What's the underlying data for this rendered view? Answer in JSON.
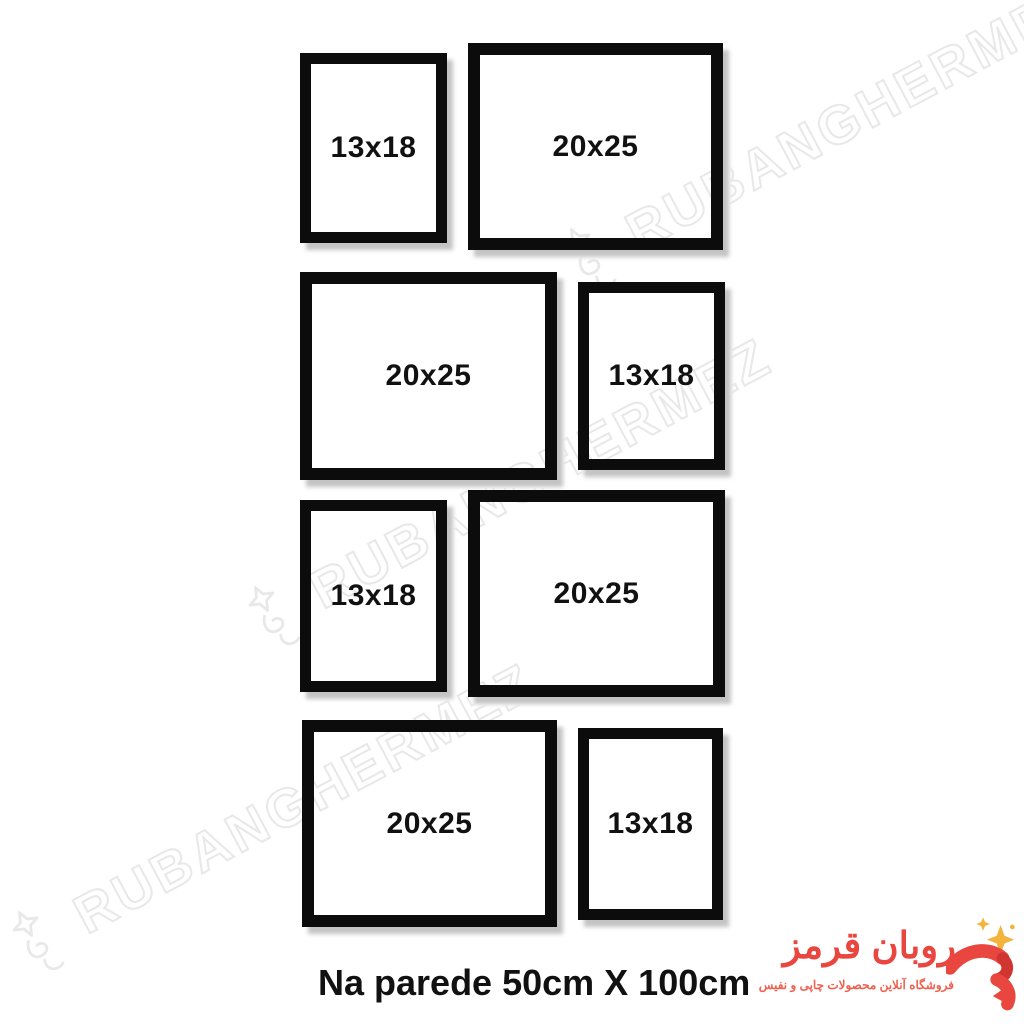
{
  "caption": "Na parede 50cm X 100cm",
  "frames": [
    {
      "label": "13x18",
      "size_cm": "13x18",
      "orientation": "portrait",
      "row": 1,
      "position": "left"
    },
    {
      "label": "20x25",
      "size_cm": "20x25",
      "orientation": "landscape",
      "row": 1,
      "position": "right"
    },
    {
      "label": "20x25",
      "size_cm": "20x25",
      "orientation": "landscape",
      "row": 2,
      "position": "left"
    },
    {
      "label": "13x18",
      "size_cm": "13x18",
      "orientation": "portrait",
      "row": 2,
      "position": "right"
    },
    {
      "label": "13x18",
      "size_cm": "13x18",
      "orientation": "portrait",
      "row": 3,
      "position": "left"
    },
    {
      "label": "20x25",
      "size_cm": "20x25",
      "orientation": "landscape",
      "row": 3,
      "position": "right"
    },
    {
      "label": "20x25",
      "size_cm": "20x25",
      "orientation": "landscape",
      "row": 4,
      "position": "left"
    },
    {
      "label": "13x18",
      "size_cm": "13x18",
      "orientation": "portrait",
      "row": 4,
      "position": "right"
    }
  ],
  "watermark": {
    "text": "RUBANGHERMEZ"
  },
  "logo": {
    "title": "روبان قرمز",
    "subtitle": "فروشگاه آنلاین محصولات چاپی و نفیس"
  },
  "colors": {
    "background": "#ffffff",
    "frame_border": "#0c0c0c",
    "label_text": "#111111",
    "watermark_stroke": "#e4e4e4",
    "brand_red": "#e8463f",
    "brand_red_dark": "#d0352f",
    "subtitle_red": "#ee6150",
    "sparkle_gold": "#f3b33c"
  }
}
